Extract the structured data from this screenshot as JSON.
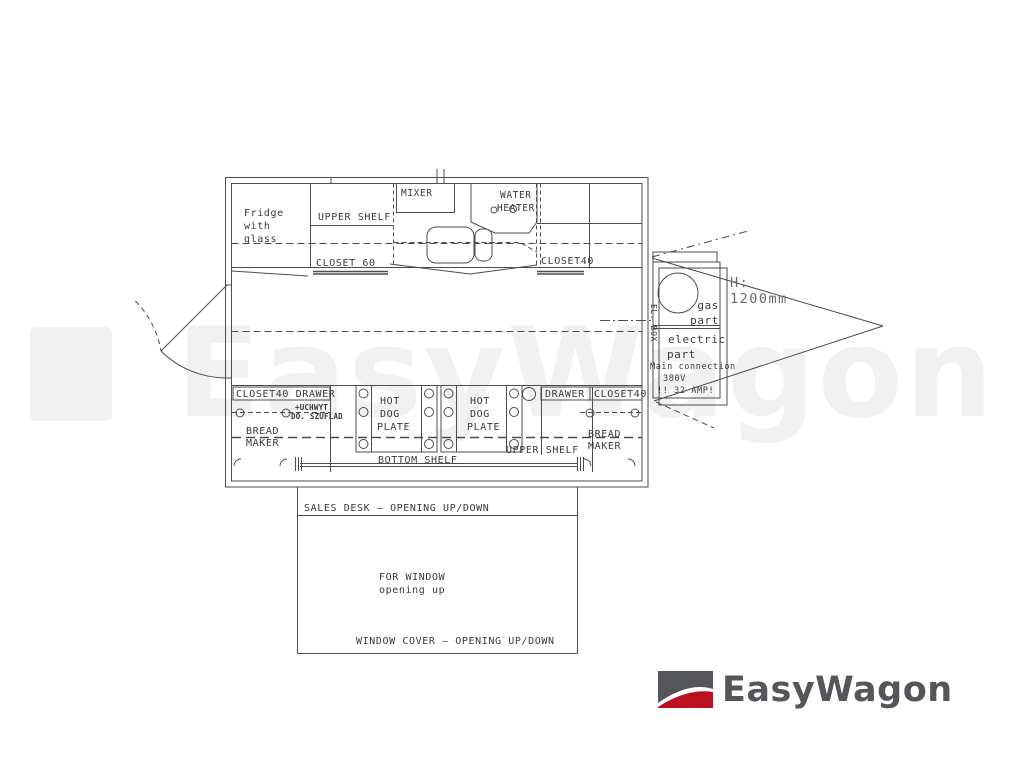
{
  "colors": {
    "line": "#4d4d4d",
    "text": "#3a3a3a",
    "watermark": "#f1f1f1",
    "logo_gray": "#55565a",
    "logo_red": "#bb1020"
  },
  "watermark": {
    "text": "EasyWagon"
  },
  "brand": {
    "name": "EasyWagon"
  },
  "plan": {
    "fridge": {
      "l1": "Fridge",
      "l2": "with",
      "l3": "glass"
    },
    "upper_shelf_top": "UPPER SHELF",
    "mixer": "MIXER",
    "water_heater": {
      "l1": "WATER",
      "l2": "HEATER"
    },
    "closet60": "CLOSET 60",
    "closet40_top": "CLOSET40",
    "el_box": "EL. BOX",
    "closet40_drawer": "CLOSET40 DRAWER",
    "uchwyt": {
      "l1": "+UCHWYT",
      "l2": "DO. SZUFLAD"
    },
    "bread_maker_left": {
      "l1": "BREAD",
      "l2": "MAKER"
    },
    "bread_maker_right": {
      "l1": "BREAD",
      "l2": "MAKER"
    },
    "hot_dog_left": {
      "l1": "HOT",
      "l2": "DOG",
      "l3": "PLATE"
    },
    "hot_dog_right": {
      "l1": "HOT",
      "l2": "DOG",
      "l3": "PLATE"
    },
    "drawer": "DRAWER",
    "closet40_bottom": "CLOSET40",
    "upper_shelf_bottom": "UPPER SHELF",
    "bottom_shelf": "BOTTOM SHELF",
    "gas_part": {
      "l1": "gas",
      "l2": "part"
    },
    "electric_part": {
      "l1": "electric",
      "l2": "part"
    },
    "main_connection": {
      "l1": "Main connection",
      "l2": "380V",
      "l3": "!!  32 AMP!"
    },
    "height": {
      "l1": "H:",
      "l2": "1200mm"
    },
    "sales_desk": "SALES DESK – OPENING UP/DOWN",
    "for_window": {
      "l1": "FOR WINDOW",
      "l2": "opening up"
    },
    "window_cover": "WINDOW COVER – OPENING UP/DOWN"
  }
}
